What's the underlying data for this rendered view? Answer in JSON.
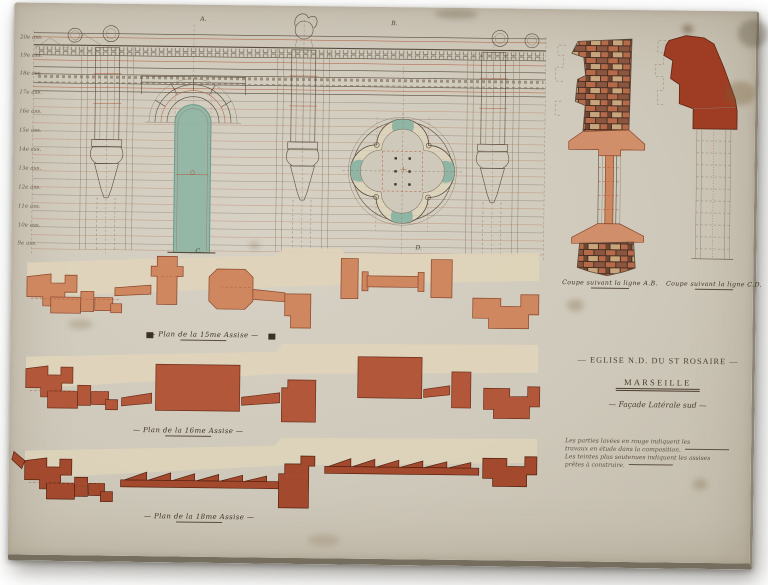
{
  "colors": {
    "photo-bg": "#ffffff",
    "paper": "#cfc9bb",
    "cream": "#e0d5ba",
    "teal": "#8fb5a4",
    "teal-dark": "#6f998a",
    "salmon": "#cf8760",
    "terra": "#b3573a",
    "dred": "#a3492e",
    "redsolid": "#9e3d24",
    "ink": "#5a4c3c",
    "ink-faint": "#8d7f6d",
    "ink-red": "#b05a3c",
    "text": "#4a3c2e",
    "brick1": "#8a5640",
    "brick2": "#b56a4a",
    "brick3": "#6e4432",
    "brick4": "#c7a67e",
    "mortar": "#4a2f22"
  },
  "elevation": {
    "letters": {
      "a": "A.",
      "b": "B.",
      "c": "C.",
      "d": "D."
    },
    "level_labels": [
      "20e ass.",
      "19e ass.",
      "18e ass.",
      "17e ass.",
      "16e ass.",
      "15e ass.",
      "14e ass.",
      "13e ass.",
      "12e ass.",
      "11e ass.",
      "10e ass.",
      "9e ass."
    ]
  },
  "sections": {
    "ab_caption": "Coupe suivant la ligne A.B.",
    "cd_caption": "Coupe suivant la ligne C.D."
  },
  "plans": {
    "p15_caption": "— Plan de la 15me Assise —",
    "p16_caption": "— Plan de la 16me Assise —",
    "p18_caption": "— Plan de la 18me Assise —"
  },
  "title_block": {
    "line1": "— EGLISE  N.D. DU ST ROSAIRE —",
    "line2": "MARSEILLE",
    "line3": "— Façade Latérale sud —",
    "note_lines": [
      "Les parties lavées en rouge indiquent les",
      "travaux en étude dans la composition.",
      "Les teintes plus soutenues indiquent les assises",
      "prêtes à construire."
    ]
  }
}
